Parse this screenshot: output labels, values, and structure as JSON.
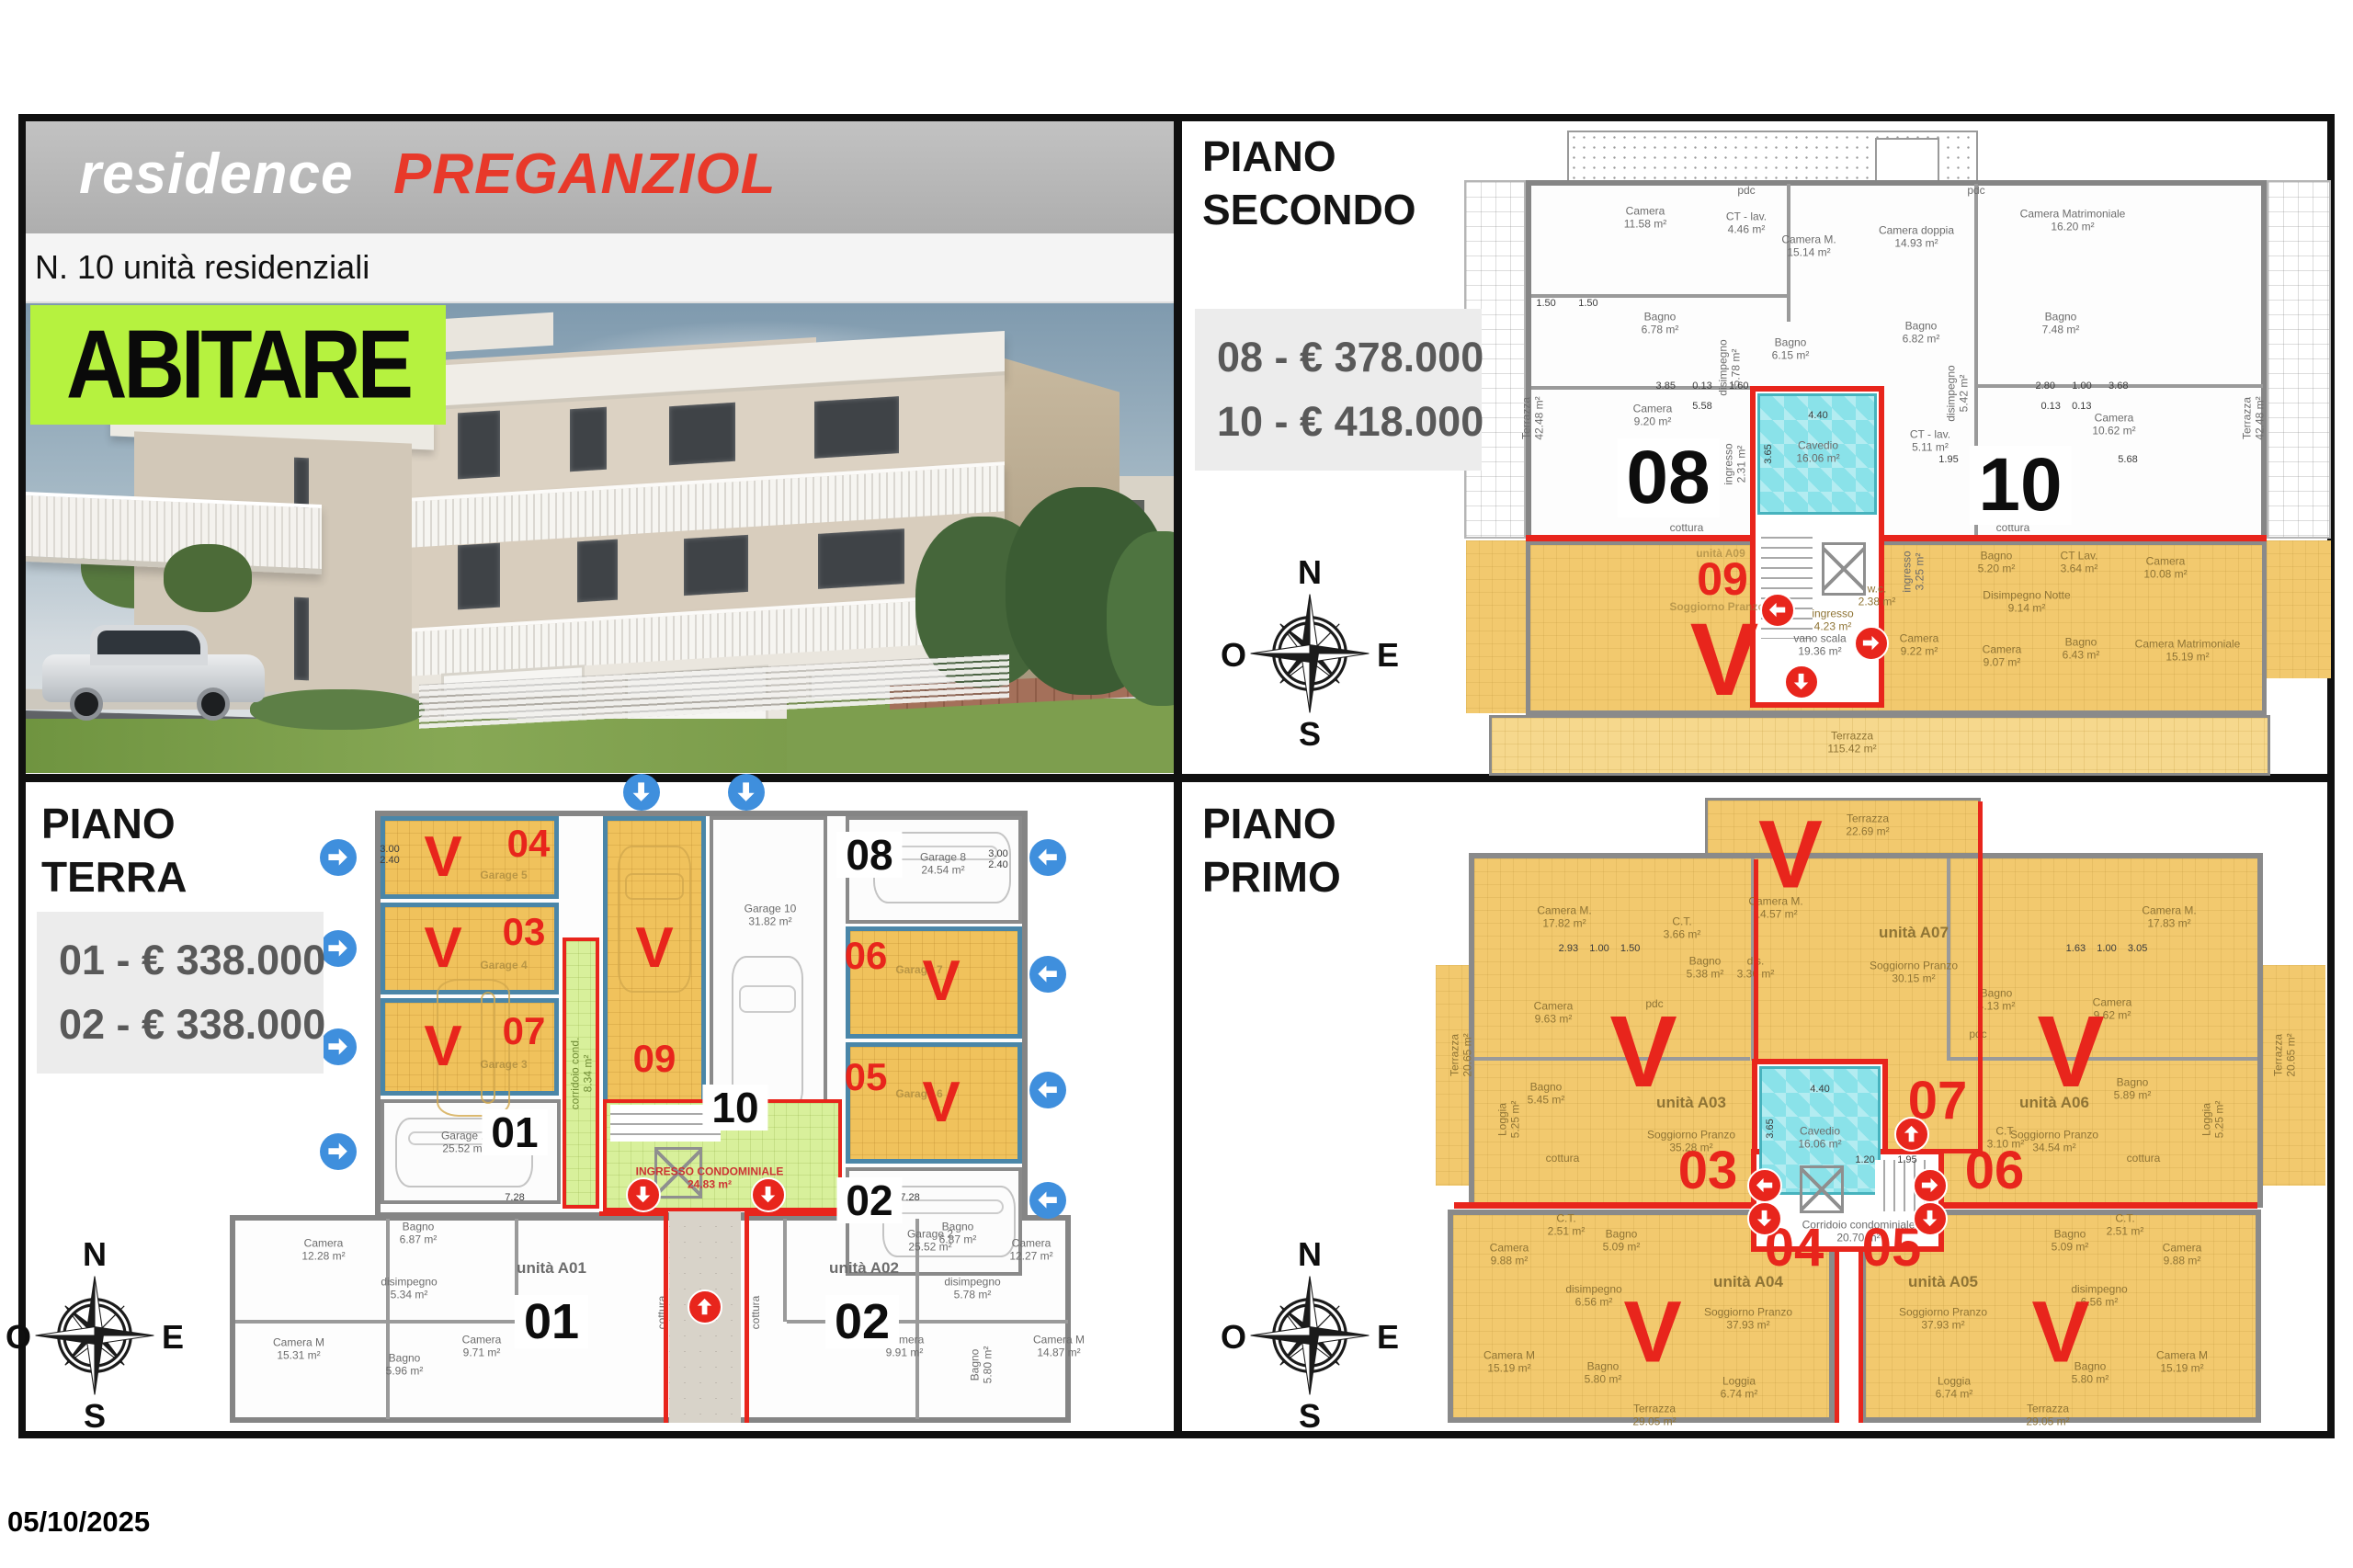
{
  "header": {
    "brand": "residence",
    "project": "PREGANZIOL",
    "subtitle": "N. 10 unità residenziali",
    "logo": "ABITARE"
  },
  "footer": {
    "date": "05/10/2025"
  },
  "compass": {
    "n": "N",
    "e": "E",
    "s": "S",
    "o": "O"
  },
  "secondo": {
    "title": "PIANO\nSECONDO",
    "price1": "08 - € 378.000",
    "price2": "10 - € 418.000",
    "num_left": "08",
    "num_right": "10",
    "sold_num": "09",
    "v": "V",
    "cavedio": "Cavedio\n16.06 m²",
    "cavedio_w": "4.40",
    "cavedio_h": "3.65",
    "vano": "vano scala\n19.36 m²",
    "rooms": [
      "pdc",
      "Camera\n11.58 m²",
      "CT - lav.\n4.46 m²",
      "Camera M.\n15.14 m²",
      "Camera doppia\n14.93 m²",
      "Camera Matrimoniale\n16.20 m²",
      "Bagno\n6.78 m²",
      "Bagno\n6.15 m²",
      "disimpegno\n5.78 m²",
      "Camera\n9.20 m²",
      "Bagno\n6.82 m²",
      "Bagno\n7.48 m²",
      "disimpegno\n5.42 m²",
      "CT - lav.\n5.11 m²",
      "Camera\n10.62 m²",
      "Terrazza\n42.48 m²",
      "Terrazza\n42.48 m²",
      "cottura",
      "cottura",
      "ingresso\n2.31 m²",
      "ingresso\n3.25 m²",
      "unità A09",
      "Soggiorno Pranzo",
      "Bagno\n5.20 m²",
      "CT Lav.\n3.64 m²",
      "Camera\n10.08 m²",
      "w.c.\n2.38 m²",
      "Disimpegno Notte\n9.14 m²",
      "ingresso\n4.23 m²",
      "Camera\n9.22 m²",
      "Camera\n9.07 m²",
      "Bagno\n6.43 m²",
      "Camera Matrimoniale\n15.19 m²",
      "Terrazza\n115.42 m²",
      "pdc"
    ],
    "dims": [
      "3.85      0.13      1.60",
      "5.58",
      "2.80      1.00      3.68",
      "0.13    0.13",
      "1.95",
      "5.68",
      "1.50        1.50"
    ]
  },
  "terra": {
    "title": "PIANO\nTERRA",
    "price1": "01 - € 338.000",
    "price2": "02 - € 338.000",
    "v": "V",
    "n04": "04",
    "n03": "03",
    "n07": "07",
    "n09": "09",
    "n10": "10",
    "n08": "08",
    "n06": "06",
    "n05": "05",
    "n01": "01",
    "n02": "02",
    "a01": "01",
    "a02": "02",
    "rooms": [
      "Camera\n12.28 m²",
      "Bagno\n6.87 m²",
      "disimpegno\n5.34 m²",
      "Camera M\n15.31 m²",
      "Bagno\n5.96 m²",
      "Camera\n9.71 m²",
      "unità A01",
      "cottura",
      "Bagno\n6.87 m²",
      "Camera\n12.27 m²",
      "disimpegno\n5.78 m²",
      "Camera\n9.91 m²",
      "Bagno\n5.80 m²",
      "Camera M\n14.87 m²",
      "unità A02",
      "cottura",
      "Garage 5",
      "Garage 4",
      "Garage 3",
      "Garage 10\n31.82 m²",
      "Garage 8\n24.54 m²",
      "Garage 1\n25.52 m²",
      "Garage 2\n25.52 m²",
      "corridoio cond.\n8.34 m²",
      "INGRESSO CONDOMINIALE\n24.83 m²",
      "Garage 7",
      "Garage 6"
    ],
    "dims": [
      "7.28",
      "7.28",
      "3.00\n2.40",
      "3.00\n2.40"
    ]
  },
  "primo": {
    "title": "PIANO\nPRIMO",
    "v": "V",
    "n07": "07",
    "n03": "03",
    "n06": "06",
    "n04": "04",
    "n05": "05",
    "cavedio": "Cavedio\n16.06 m²",
    "cavedio_w": "4.40",
    "cavedio_h": "3.65",
    "corridoio": "Corridoio condominiale\n20.70 m²",
    "rooms": [
      "Camera M.\n17.82 m²",
      "C.T.\n3.66 m²",
      "Camera\n9.63 m²",
      "Bagno\n5.45 m²",
      "Bagno\n5.38 m²",
      "dis.\n3.36 m²",
      "Camera M.\n14.57 m²",
      "unità A07",
      "Soggiorno Pranzo\n30.15 m²",
      "Camera M.\n17.83 m²",
      "Bagno\n4.13 m²",
      "Camera\n9.62 m²",
      "Bagno\n5.89 m²",
      "C.T.\n3.10 m²",
      "cottura",
      "cottura",
      "Terrazza\n22.69 m²",
      "Terrazza\n20.65 m²",
      "Loggia\n5.25 m²",
      "Terrazza\n20.65 m²",
      "Loggia\n5.25 m²",
      "unità A03",
      "Soggiorno Pranzo\n35.28 m²",
      "unità A06",
      "Soggiorno Pranzo\n34.54 m²",
      "Camera\n9.88 m²",
      "C.T.\n2.51 m²",
      "Bagno\n5.09 m²",
      "disimpegno\n6.56 m²",
      "Camera M\n15.19 m²",
      "Bagno\n5.80 m²",
      "unità A04",
      "Soggiorno Pranzo\n37.93 m²",
      "Loggia\n6.74 m²",
      "Terrazza\n29.05 m²",
      "Bagno\n5.09 m²",
      "C.T.\n2.51 m²",
      "Camera\n9.88 m²",
      "disimpegno\n6.56 m²",
      "unità A05",
      "Soggiorno Pranzo\n37.93 m²",
      "Loggia\n6.74 m²",
      "Bagno\n5.80 m²",
      "Camera M\n15.19 m²",
      "Terrazza\n29.05 m²",
      "pdc",
      "pdc"
    ],
    "dims": [
      "1.20        1.95",
      "2.93    1.00    1.50",
      "1.63    1.00    3.05"
    ]
  }
}
